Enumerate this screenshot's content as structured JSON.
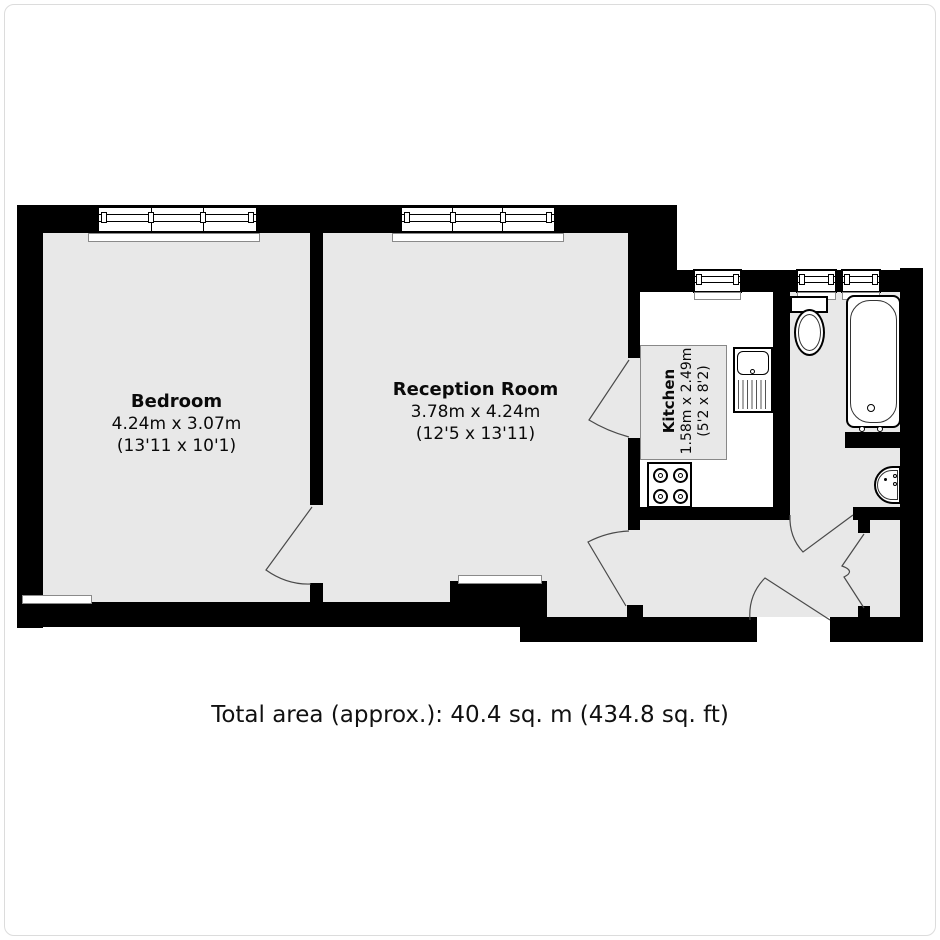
{
  "plan": {
    "rooms": [
      {
        "name": "Bedroom",
        "metric": "4.24m x 3.07m",
        "imperial": "(13'11 x 10'1)"
      },
      {
        "name": "Reception Room",
        "metric": "3.78m x 4.24m",
        "imperial": "(12'5 x 13'11)"
      },
      {
        "name": "Kitchen",
        "metric": "1.58m x 2.49m",
        "imperial": "(5'2 x 8'2)"
      }
    ],
    "footer": "Total area (approx.): 40.4 sq. m (434.8 sq. ft)",
    "colors": {
      "wall": "#000000",
      "floor": "#e8e8e8",
      "door_stroke": "#4a4a4a",
      "sill_border": "#8a8a8a"
    }
  }
}
